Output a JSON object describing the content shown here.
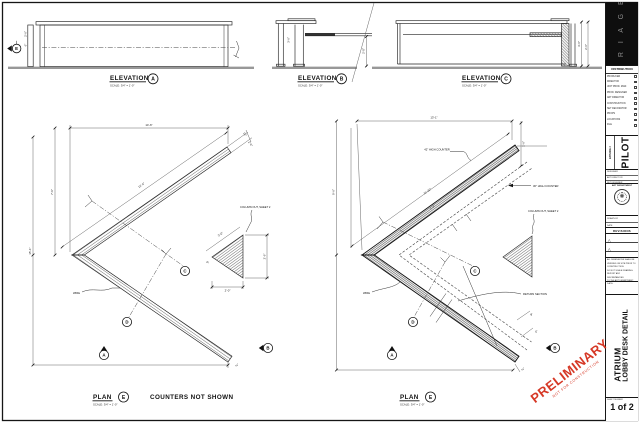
{
  "labels": {
    "elevation": "ELEVATION",
    "plan": "PLAN",
    "scale": "SCALE: 3/4\" = 1'-0\"",
    "counters_note": "COUNTERS NOT SHOWN"
  },
  "markers": {
    "a": "A",
    "b": "B",
    "c": "C",
    "d": "D",
    "e": "E"
  },
  "ann": {
    "column_out": "COLUMN OUT, SHEET 2",
    "counter42": "42\" HIGH COUNTER",
    "counter30": "30\" HIGH COUNTER",
    "return_section": "RETURN SECTION",
    "wire": "WIRE",
    "wire2": "WIRE"
  },
  "dims": {
    "eA1": "2'-6\"",
    "eA2": "6\"",
    "eB1": "3'-6\"",
    "eB2": "2'-0\"",
    "eC1": "3'-6\"",
    "eC2": "2'-6\"",
    "pL_top": "14'-6\"",
    "pL_left": "15'-1\"",
    "pL_left2": "7'-9\"",
    "pL_diag": "12'-4\"",
    "pL_tip1": "10\"",
    "pL_tip2": "2'-0\"",
    "pL_tip3": "¾\"",
    "tri_h": "2'-6\"",
    "tri_w": "2'-0\"",
    "tri_d": "3'-0\"",
    "tri_s": "6\"",
    "pR_top": "13'-1\"",
    "pR_left": "9'-6\"",
    "pR_diag": "11'-10\"",
    "pR_right": "1'-6\"",
    "pR_bar": "1'-3\"",
    "pR_s1": "9\"",
    "pR_s2": "6\"",
    "pR_tip": "¾\""
  },
  "titleblock": {
    "logo_letters": "T R I A G E",
    "distribution": {
      "header": "DISTRIBUTION",
      "items": [
        "PRODUCER",
        "DIRECTOR",
        "UNIT PROD. MGR.",
        "PROD. DESIGNER",
        "ART DIRECTOR",
        "CONSTRUCTION",
        "SET DECORATOR",
        "PROPS",
        "LOCATIONS",
        "FILE"
      ]
    },
    "episode_label": "EPISODE #",
    "episode_value": "PILOT",
    "info_rows": [
      "DESIGNER",
      "ART DIRECTOR",
      "SET DESIGNER"
    ],
    "seal_header": "ART DEPARTMENT",
    "seal_glyph": "✺",
    "sig_rows": [
      "DRAWN BY",
      "DATE"
    ],
    "revisions_header": "REVISIONS",
    "revision_glyph": "△",
    "notes": [
      "ALL DIMENSIONS SHALL BE",
      "VERIFIED ON SITE PRIOR TO",
      "CONSTRUCTION.",
      "DO NOT SCALE DRAWING.",
      "REPORT ANY DISCREPANCIES",
      "TO THE ART DEPARTMENT."
    ],
    "date_label": "DATE:",
    "title_line1": "ATRIUM",
    "title_line2": "LOBBY DESK DETAIL",
    "sheet_label": "SHEET NUMBER",
    "sheet_value": "1 of 2"
  },
  "stamp": {
    "text": "PRELIMINARY",
    "subtext": "NOT FOR CONSTRUCTION"
  },
  "colors": {
    "stamp_red": "#d63826",
    "paper": "#ffffff",
    "line": "#1a1a1a",
    "logo_bg": "#0e0e0e"
  }
}
